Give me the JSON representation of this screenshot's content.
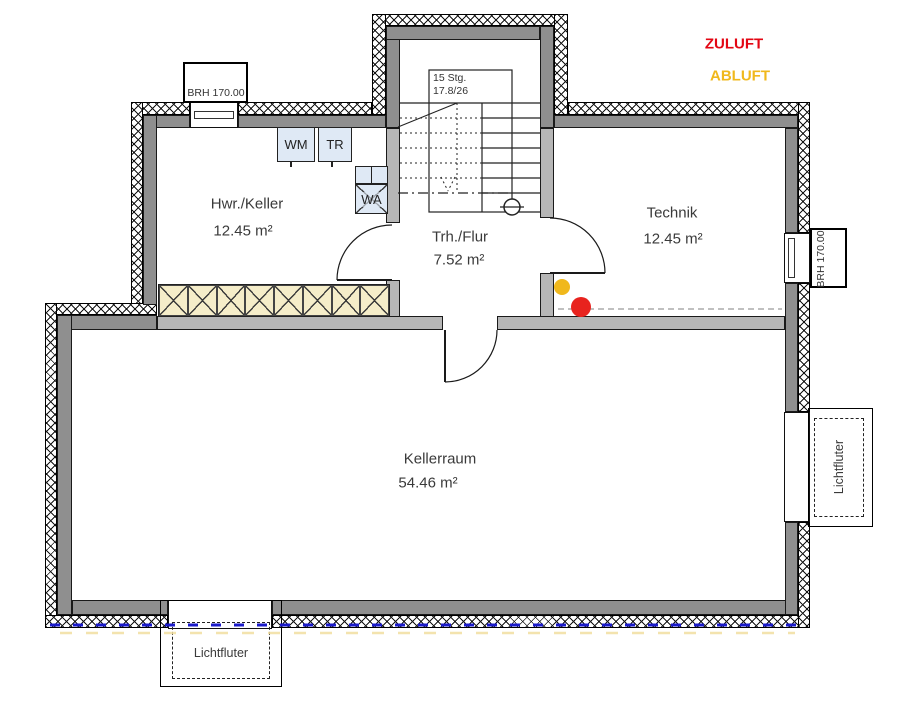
{
  "legend": {
    "items": [
      {
        "label": "ZULUFT",
        "color": "#e30613"
      },
      {
        "label": "ABLUFT",
        "color": "#f0b81c"
      }
    ]
  },
  "rooms": [
    {
      "name": "Hwr./Keller",
      "area": "12.45 m²"
    },
    {
      "name": "Trh./Flur",
      "area": "7.52 m²"
    },
    {
      "name": "Technik",
      "area": "12.45 m²"
    },
    {
      "name": "Kellerraum",
      "area": "54.46 m²"
    }
  ],
  "stair": {
    "line1": "15 Stg.",
    "line2": "17.8/26"
  },
  "appliances": {
    "wm": "WM",
    "tr": "TR",
    "wa": "WA"
  },
  "windows": {
    "top_left_label": "BRH 170.00",
    "right_label": "BRH 170.00"
  },
  "light_shafts": {
    "bottom_label": "Lichtfluter",
    "right_label": "Lichtfluter"
  },
  "colors": {
    "zuluft_text": "#e30613",
    "abluft_text": "#f0b81c",
    "supply_dot": "#e8231e",
    "exhaust_dot": "#f0b81c",
    "exterior_wall": "#8f8f8f",
    "interior_wall": "#b6b6b6",
    "shelf_fill": "#f5edc9",
    "appliance_fill": "#dfe9f5",
    "perimeter_line": "#1a1acb"
  }
}
